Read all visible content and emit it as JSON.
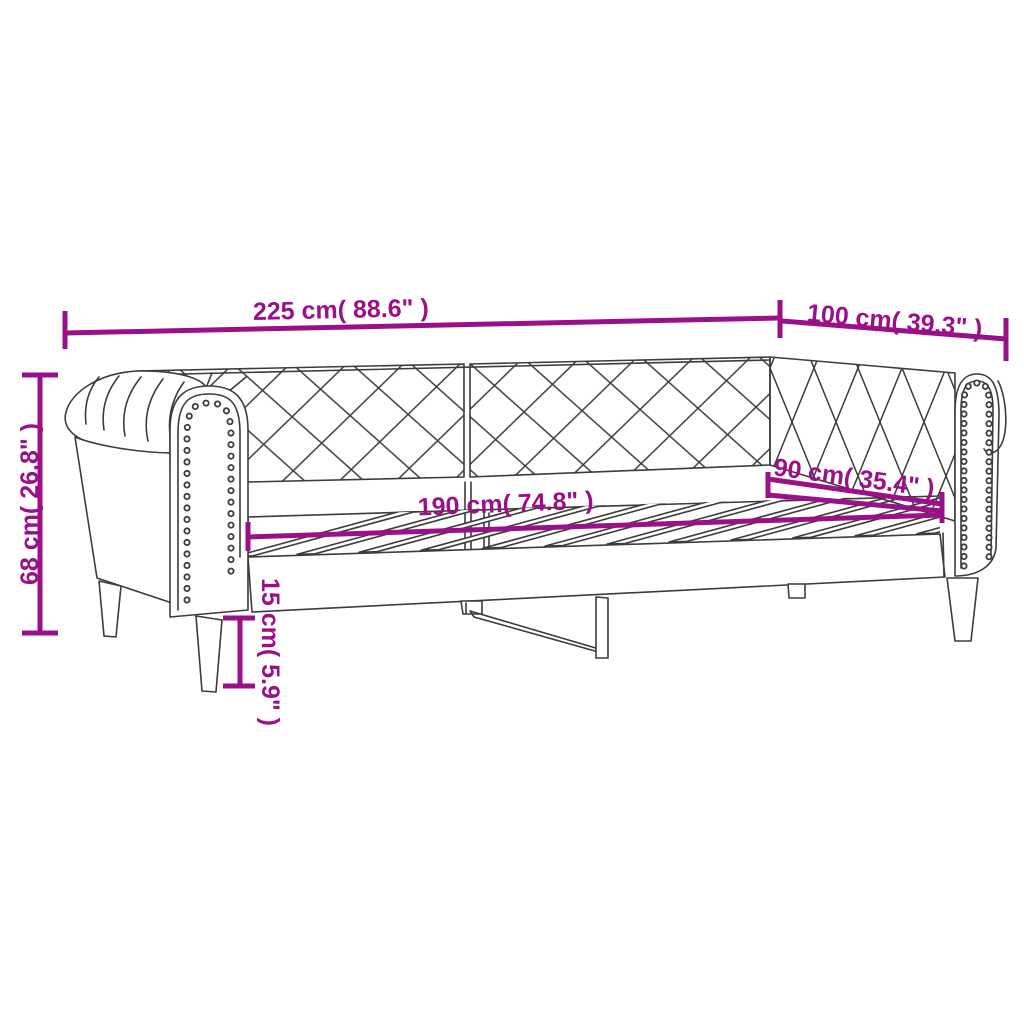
{
  "figure": {
    "kind": "product-dimension-diagram",
    "subject": "daybed with chesterfield arms, tufted backrest, nailhead trim and slatted bed base"
  },
  "style": {
    "annotation_color": "#9B1089",
    "line_color": "#3C3C3C",
    "background_color": "#FFFFFF"
  },
  "dimensions": {
    "total_length": "225 cm( 88.6\" )",
    "total_depth": "100 cm( 39.3\" )",
    "total_height": "68 cm( 26.8\" )",
    "bed_length": "190 cm( 74.8\" )",
    "bed_width": "90 cm( 35.4\" )",
    "ground_clearance": "15 cm( 5.9\" )"
  }
}
